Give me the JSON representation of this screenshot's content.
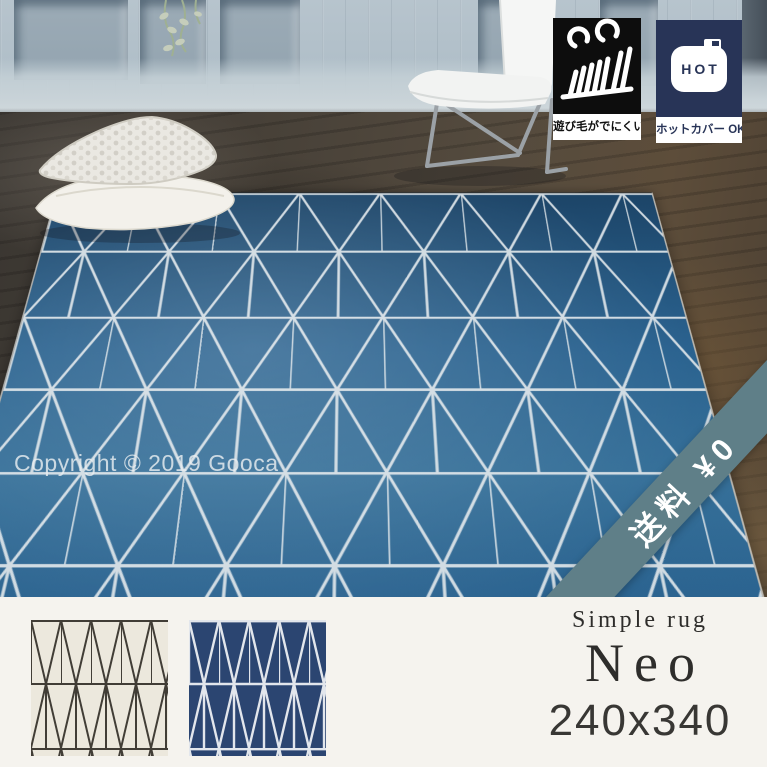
{
  "product": {
    "series_label": "Simple rug",
    "name": "Neo",
    "size": "240x340"
  },
  "overlays": {
    "copyright": "Copyright © 2019 Gooca",
    "free_shipping_ribbon": "送料 ¥0",
    "lint_badge_label": "遊び毛がでにくい",
    "hot_badge_label": "ホットカバー OK!",
    "hot_badge_icon_text": "HOT"
  },
  "swatches": [
    {
      "name": "ivory",
      "pattern": "triangle-lattice"
    },
    {
      "name": "navy",
      "pattern": "triangle-lattice"
    }
  ],
  "icons": {
    "lint": "carpet-pile-lint-icon",
    "hot": "hot-carpet-cover-icon"
  },
  "colors": {
    "badge-navy": "#283457",
    "ribbon-teal": "#5f7f88",
    "strip-bg": "#f5f3ee",
    "wall": "#b2c0c9",
    "rug-dark": "#1c4467",
    "rug-mid": "#2a628f",
    "rug-light": "#367099",
    "rug-line": "#dde4e9",
    "swatch-ivory-bg": "#ece8dd",
    "swatch-ivory-line": "#413d36",
    "swatch-navy-bg": "#2b4571",
    "swatch-navy-line": "#e2e6ec",
    "text-dark": "#2e2d2b"
  }
}
